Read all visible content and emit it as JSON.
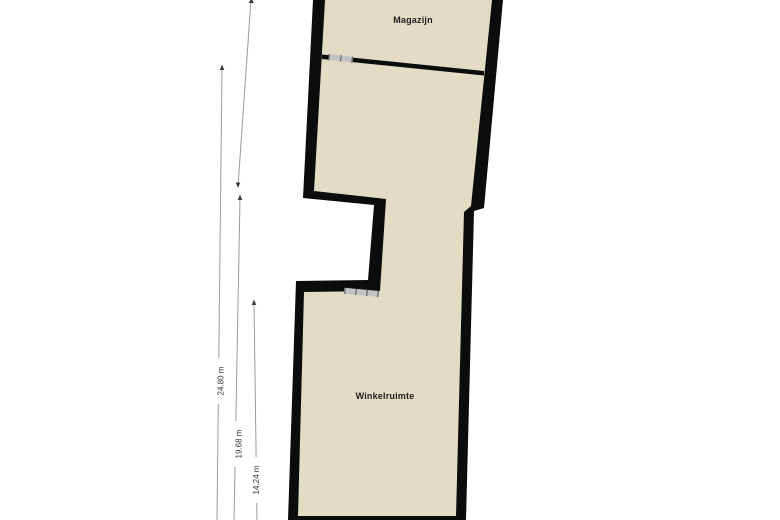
{
  "plan": {
    "rooms": [
      {
        "label": "Magazijn"
      },
      {
        "label": "Winkelruimte"
      }
    ],
    "dimensions": [
      {
        "label": "24.80 m"
      },
      {
        "label": "19.68 m"
      },
      {
        "label": "14.24 m"
      }
    ]
  },
  "colors": {
    "page_background": "#ffffff",
    "wall": "#0c0c0c",
    "room_fill": "#e3dcc4",
    "window_fill": "#c3c3c3",
    "window_tick": "#4f4f4f",
    "dimension_line": "#9b9b9b",
    "dimension_arrow": "#3c3c3c",
    "dimension_text": "#333333",
    "room_text": "#1c1c1c"
  }
}
